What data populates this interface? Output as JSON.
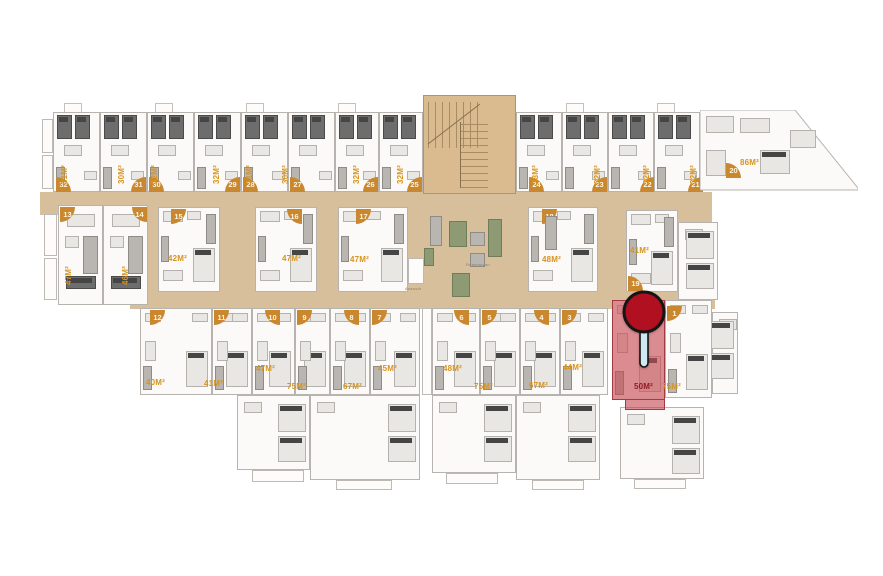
{
  "palette": {
    "corridor": "#d8bf9c",
    "staircase": "#d9bb8f",
    "badge_orange": "#c9882f",
    "badge_text": "#fdf3dc",
    "area_label_orange": "#d8931d",
    "highlight_red_fill": "rgba(197,72,80,0.62)",
    "highlight_red_border": "#a23a41",
    "highlight_label_red": "#8e1c24",
    "pin_head_red": "#b01020",
    "pin_stem_blue": "#cfe9f2",
    "wall_gray": "#b7b4b0"
  },
  "lobby": {
    "reception_label": "Resepsiyon",
    "elevator_label": "Asansör"
  },
  "highlighted_unit": {
    "no": "2",
    "area": "50M²"
  },
  "pin": {
    "attached_unit": "2"
  },
  "units": [
    {
      "no": "32",
      "area": "31M²",
      "x": 53,
      "y": 112,
      "w": 47,
      "h": 80,
      "row": "top",
      "badge": {
        "x": 56,
        "y": 177,
        "corner": "tr"
      },
      "label": {
        "x": 60,
        "y": 184,
        "rot": 1
      }
    },
    {
      "no": "31",
      "area": "30M²",
      "x": 100,
      "y": 112,
      "w": 47,
      "h": 80,
      "row": "top",
      "badge": {
        "x": 131,
        "y": 177,
        "corner": "tl"
      },
      "label": {
        "x": 117,
        "y": 184,
        "rot": 1
      }
    },
    {
      "no": "30",
      "area": "32M²",
      "x": 147,
      "y": 112,
      "w": 47,
      "h": 80,
      "row": "top",
      "badge": {
        "x": 149,
        "y": 177,
        "corner": "tr"
      },
      "label": {
        "x": 150,
        "y": 184,
        "rot": 1
      }
    },
    {
      "no": "29",
      "area": "32M²",
      "x": 194,
      "y": 112,
      "w": 47,
      "h": 80,
      "row": "top",
      "badge": {
        "x": 225,
        "y": 177,
        "corner": "tl"
      },
      "label": {
        "x": 212,
        "y": 184,
        "rot": 1
      }
    },
    {
      "no": "28",
      "area": "31M²",
      "x": 241,
      "y": 112,
      "w": 47,
      "h": 80,
      "row": "top",
      "badge": {
        "x": 243,
        "y": 177,
        "corner": "tr"
      },
      "label": {
        "x": 245,
        "y": 184,
        "rot": 1
      }
    },
    {
      "no": "27",
      "area": "30M²",
      "x": 288,
      "y": 112,
      "w": 47,
      "h": 80,
      "row": "top",
      "badge": {
        "x": 290,
        "y": 177,
        "corner": "tr"
      },
      "label": {
        "x": 281,
        "y": 184,
        "rot": 1
      }
    },
    {
      "no": "26",
      "area": "32M²",
      "x": 335,
      "y": 112,
      "w": 44,
      "h": 80,
      "row": "top",
      "badge": {
        "x": 363,
        "y": 177,
        "corner": "tl"
      },
      "label": {
        "x": 352,
        "y": 184,
        "rot": 1
      }
    },
    {
      "no": "25",
      "area": "32M²",
      "x": 379,
      "y": 112,
      "w": 44,
      "h": 80,
      "row": "top",
      "badge": {
        "x": 407,
        "y": 177,
        "corner": "tl"
      },
      "label": {
        "x": 396,
        "y": 184,
        "rot": 1
      }
    },
    {
      "no": "24",
      "area": "33M²",
      "x": 516,
      "y": 112,
      "w": 46,
      "h": 80,
      "row": "top",
      "badge": {
        "x": 529,
        "y": 177,
        "corner": "tr"
      },
      "label": {
        "x": 531,
        "y": 184,
        "rot": 1
      }
    },
    {
      "no": "23",
      "area": "32M²",
      "x": 562,
      "y": 112,
      "w": 46,
      "h": 80,
      "row": "top",
      "badge": {
        "x": 592,
        "y": 177,
        "corner": "tl"
      },
      "label": {
        "x": 593,
        "y": 184,
        "rot": 1
      }
    },
    {
      "no": "22",
      "area": "32M²",
      "x": 608,
      "y": 112,
      "w": 46,
      "h": 80,
      "row": "top",
      "badge": {
        "x": 640,
        "y": 177,
        "corner": "tl"
      },
      "label": {
        "x": 642,
        "y": 184,
        "rot": 1
      }
    },
    {
      "no": "21",
      "area": "32M²",
      "x": 654,
      "y": 112,
      "w": 46,
      "h": 80,
      "row": "top",
      "badge": {
        "x": 688,
        "y": 177,
        "corner": "tl"
      },
      "label": {
        "x": 689,
        "y": 184,
        "rot": 1
      }
    },
    {
      "no": "20",
      "area": "86M²",
      "x": 700,
      "y": 110,
      "w": 158,
      "h": 82,
      "row": "big",
      "poly": "0,0 95,0 158,78 158,80 0,80",
      "badge": {
        "x": 726,
        "y": 163,
        "corner": "tr"
      },
      "label": {
        "x": 740,
        "y": 158,
        "rot": 0
      }
    },
    {
      "no": "13",
      "area": "47M²",
      "x": 58,
      "y": 205,
      "w": 45,
      "h": 100,
      "row": "tall",
      "badge": {
        "x": 60,
        "y": 207,
        "corner": "br"
      },
      "label": {
        "x": 64,
        "y": 285,
        "rot": 1
      }
    },
    {
      "no": "14",
      "area": "46M²",
      "x": 103,
      "y": 205,
      "w": 45,
      "h": 100,
      "row": "tall",
      "badge": {
        "x": 132,
        "y": 207,
        "corner": "bl"
      },
      "label": {
        "x": 121,
        "y": 285,
        "rot": 1
      }
    },
    {
      "no": "15",
      "area": "42M²",
      "x": 158,
      "y": 207,
      "w": 62,
      "h": 85,
      "row": "mid",
      "badge": {
        "x": 171,
        "y": 209,
        "corner": "br"
      },
      "label": {
        "x": 168,
        "y": 254,
        "rot": 0
      }
    },
    {
      "no": "16",
      "area": "47M²",
      "x": 255,
      "y": 207,
      "w": 62,
      "h": 85,
      "row": "mid",
      "badge": {
        "x": 287,
        "y": 209,
        "corner": "bl"
      },
      "label": {
        "x": 282,
        "y": 254,
        "rot": 0
      }
    },
    {
      "no": "17",
      "area": "47M²",
      "x": 338,
      "y": 207,
      "w": 70,
      "h": 85,
      "row": "mid",
      "badge": {
        "x": 356,
        "y": 209,
        "corner": "br"
      },
      "label": {
        "x": 350,
        "y": 255,
        "rot": 0
      }
    },
    {
      "no": "18",
      "area": "48M²",
      "x": 528,
      "y": 207,
      "w": 70,
      "h": 85,
      "row": "mid",
      "badge": {
        "x": 542,
        "y": 209,
        "corner": "br"
      },
      "label": {
        "x": 542,
        "y": 255,
        "rot": 0
      }
    },
    {
      "no": "19",
      "area": "41M²",
      "x": 626,
      "y": 210,
      "w": 52,
      "h": 82,
      "row": "mid",
      "badge": {
        "x": 628,
        "y": 276,
        "corner": "tr"
      },
      "label": {
        "x": 630,
        "y": 246,
        "rot": 0
      }
    },
    {
      "no": "12",
      "area": "40M²",
      "x": 140,
      "y": 308,
      "w": 72,
      "h": 87,
      "row": "bottom",
      "badge": {
        "x": 150,
        "y": 310,
        "corner": "br"
      },
      "label": {
        "x": 146,
        "y": 378,
        "rot": 0
      }
    },
    {
      "no": "11",
      "area": "41M²",
      "x": 212,
      "y": 308,
      "w": 40,
      "h": 87,
      "row": "bottom",
      "badge": {
        "x": 214,
        "y": 310,
        "corner": "br"
      },
      "label": {
        "x": 204,
        "y": 379,
        "rot": 0
      }
    },
    {
      "no": "10",
      "area": "47M²",
      "x": 252,
      "y": 308,
      "w": 43,
      "h": 87,
      "row": "bottom",
      "badge": {
        "x": 265,
        "y": 310,
        "corner": "bl"
      },
      "label": {
        "x": 256,
        "y": 364,
        "rot": 0
      }
    },
    {
      "no": "9",
      "area": "75M²",
      "x": 295,
      "y": 308,
      "w": 35,
      "h": 87,
      "row": "bottom",
      "badge": {
        "x": 297,
        "y": 310,
        "corner": "br"
      },
      "label": {
        "x": 287,
        "y": 382,
        "rot": 0
      }
    },
    {
      "no": "8",
      "area": "67M²",
      "x": 330,
      "y": 308,
      "w": 40,
      "h": 87,
      "row": "bottom",
      "badge": {
        "x": 344,
        "y": 310,
        "corner": "bl"
      },
      "label": {
        "x": 343,
        "y": 382,
        "rot": 0
      }
    },
    {
      "no": "7",
      "area": "45M²",
      "x": 370,
      "y": 308,
      "w": 50,
      "h": 87,
      "row": "bottom",
      "badge": {
        "x": 372,
        "y": 310,
        "corner": "br"
      },
      "label": {
        "x": 378,
        "y": 364,
        "rot": 0
      }
    },
    {
      "no": "6",
      "area": "48M²",
      "x": 432,
      "y": 308,
      "w": 48,
      "h": 87,
      "row": "bottom",
      "badge": {
        "x": 454,
        "y": 310,
        "corner": "bl"
      },
      "label": {
        "x": 443,
        "y": 364,
        "rot": 0
      }
    },
    {
      "no": "5",
      "area": "75M²",
      "x": 480,
      "y": 308,
      "w": 40,
      "h": 87,
      "row": "bottom",
      "badge": {
        "x": 482,
        "y": 310,
        "corner": "br"
      },
      "label": {
        "x": 474,
        "y": 382,
        "rot": 0
      }
    },
    {
      "no": "4",
      "area": "67M²",
      "x": 520,
      "y": 308,
      "w": 40,
      "h": 87,
      "row": "bottom",
      "badge": {
        "x": 534,
        "y": 310,
        "corner": "bl"
      },
      "label": {
        "x": 529,
        "y": 381,
        "rot": 0
      }
    },
    {
      "no": "3",
      "area": "44M²",
      "x": 560,
      "y": 308,
      "w": 48,
      "h": 87,
      "row": "bottom",
      "badge": {
        "x": 562,
        "y": 310,
        "corner": "br"
      },
      "label": {
        "x": 563,
        "y": 363,
        "rot": 0
      }
    },
    {
      "no": "2",
      "area": "50M²",
      "x": 612,
      "y": 300,
      "w": 53,
      "h": 100,
      "row": "red",
      "badge": null,
      "label": {
        "x": 634,
        "y": 382,
        "rot": 0,
        "red": 1
      }
    },
    {
      "no": "1",
      "area": "75M²",
      "x": 665,
      "y": 300,
      "w": 47,
      "h": 98,
      "row": "bottom",
      "badge": {
        "x": 667,
        "y": 306,
        "corner": "br"
      },
      "label": {
        "x": 662,
        "y": 382,
        "rot": 0
      }
    }
  ],
  "corridors": [
    {
      "x": 40,
      "y": 192,
      "w": 672,
      "h": 23
    },
    {
      "x": 130,
      "y": 288,
      "w": 585,
      "h": 21
    },
    {
      "x": 148,
      "y": 207,
      "w": 480,
      "h": 95
    },
    {
      "x": 598,
      "y": 192,
      "w": 114,
      "h": 110
    }
  ],
  "staircase": {
    "x": 423,
    "y": 95,
    "w": 93,
    "h": 99
  },
  "extensions": [
    {
      "x": 237,
      "y": 395,
      "w": 73,
      "h": 75
    },
    {
      "x": 310,
      "y": 395,
      "w": 110,
      "h": 85
    },
    {
      "x": 432,
      "y": 395,
      "w": 84,
      "h": 78
    },
    {
      "x": 516,
      "y": 395,
      "w": 84,
      "h": 85
    },
    {
      "x": 620,
      "y": 407,
      "w": 84,
      "h": 72
    },
    {
      "x": 678,
      "y": 222,
      "w": 40,
      "h": 78
    },
    {
      "x": 712,
      "y": 312,
      "w": 26,
      "h": 82
    }
  ],
  "balconies": [
    {
      "x": 252,
      "y": 470,
      "w": 52,
      "h": 12
    },
    {
      "x": 336,
      "y": 480,
      "w": 56,
      "h": 10
    },
    {
      "x": 446,
      "y": 473,
      "w": 52,
      "h": 11
    },
    {
      "x": 532,
      "y": 480,
      "w": 52,
      "h": 10
    },
    {
      "x": 634,
      "y": 479,
      "w": 52,
      "h": 10
    },
    {
      "x": 42,
      "y": 119,
      "w": 11,
      "h": 34
    },
    {
      "x": 42,
      "y": 155,
      "w": 11,
      "h": 34
    },
    {
      "x": 44,
      "y": 214,
      "w": 13,
      "h": 42
    },
    {
      "x": 44,
      "y": 258,
      "w": 13,
      "h": 42
    },
    {
      "x": 422,
      "y": 308,
      "w": 10,
      "h": 87
    }
  ],
  "roof_tabs": [
    {
      "x": 64,
      "y": 103
    },
    {
      "x": 155,
      "y": 103
    },
    {
      "x": 246,
      "y": 103
    },
    {
      "x": 338,
      "y": 103
    },
    {
      "x": 566,
      "y": 103
    },
    {
      "x": 657,
      "y": 103
    }
  ]
}
